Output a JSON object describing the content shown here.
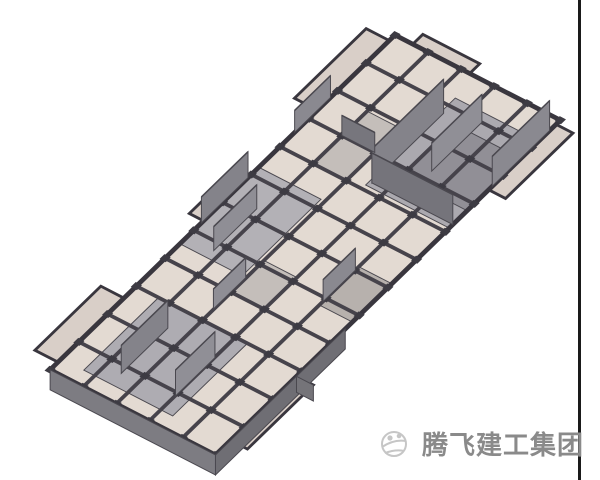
{
  "image": {
    "kind": "3d-bim-structural-floor-model",
    "background_color": "#ffffff"
  },
  "model": {
    "transform": {
      "a": 0.889,
      "b": 0.458,
      "c": -0.717,
      "d": 0.696,
      "e": 395,
      "f": 35
    },
    "slab": {
      "width_u": 186,
      "length_v": 481,
      "cols": 5,
      "rows": 12,
      "panel_color": "#e3dad2",
      "panel_color_alt": "#d9cfc8",
      "beam_color": "#46434b",
      "edge_color": "#39363e",
      "stud_color": "#3d3b43"
    },
    "wings": [
      {
        "u": -26,
        "v": 8,
        "w": 26,
        "h": 100
      },
      {
        "u": 186,
        "v": 6,
        "w": 19,
        "h": 94
      },
      {
        "u": -26,
        "v": 378,
        "w": 26,
        "h": 92
      },
      {
        "u": 186,
        "v": 368,
        "w": 19,
        "h": 92
      },
      {
        "u": -16,
        "v": 205,
        "w": 16,
        "h": 62
      },
      {
        "u": 20,
        "v": -14,
        "w": 64,
        "h": 14
      }
    ],
    "cores": [
      {
        "u": 92,
        "v": 30,
        "w": 94,
        "h": 125,
        "fill": "#aba9af"
      },
      {
        "u": 112,
        "v": 55,
        "w": 74,
        "h": 75,
        "fill": "#918f96"
      },
      {
        "u": 0,
        "v": 190,
        "w": 70,
        "h": 110,
        "fill": "#b3b1b6"
      },
      {
        "u": 25,
        "v": 360,
        "w": 100,
        "h": 105,
        "fill": "#aeacb2"
      },
      {
        "u": 37,
        "v": 85,
        "w": 37,
        "h": 75,
        "fill": "#c4beba"
      },
      {
        "u": 149,
        "v": 235,
        "w": 37,
        "h": 55,
        "fill": "#b7b1ad"
      },
      {
        "u": 74,
        "v": 275,
        "w": 38,
        "h": 45,
        "fill": "#c4beba"
      }
    ],
    "walls_up": [
      {
        "u1": 95,
        "v1": 50,
        "u2": 95,
        "v2": 150,
        "h": 34,
        "fill": "#84838a"
      },
      {
        "u1": 95,
        "v1": 150,
        "u2": 186,
        "v2": 150,
        "h": 30,
        "fill": "#75747b"
      },
      {
        "u1": 186,
        "v1": 15,
        "u2": 186,
        "v2": 95,
        "h": 30,
        "fill": "#8a8990"
      },
      {
        "u1": 130,
        "v1": 40,
        "u2": 130,
        "v2": 110,
        "h": 28,
        "fill": "#908f96"
      },
      {
        "u1": 0,
        "v1": 90,
        "u2": 0,
        "v2": 140,
        "h": 22,
        "fill": "#8a8990"
      },
      {
        "u1": 37,
        "v1": 120,
        "u2": 74,
        "v2": 120,
        "h": 20,
        "fill": "#77767d"
      },
      {
        "u1": 0,
        "v1": 205,
        "u2": 0,
        "v2": 270,
        "h": 26,
        "fill": "#84838a"
      },
      {
        "u1": 30,
        "v1": 230,
        "u2": 30,
        "v2": 290,
        "h": 24,
        "fill": "#8f8e95"
      },
      {
        "u1": 149,
        "v1": 240,
        "u2": 149,
        "v2": 285,
        "h": 22,
        "fill": "#8a8990"
      },
      {
        "u1": 74,
        "v1": 300,
        "u2": 74,
        "v2": 345,
        "h": 20,
        "fill": "#8f8e95"
      },
      {
        "u1": 55,
        "v1": 385,
        "u2": 55,
        "v2": 450,
        "h": 28,
        "fill": "#84838a"
      },
      {
        "u1": 112,
        "v1": 390,
        "u2": 112,
        "v2": 445,
        "h": 26,
        "fill": "#908f96"
      }
    ],
    "walls_down": [
      {
        "u1": 0,
        "v1": 481,
        "u2": 186,
        "v2": 481,
        "h": 20,
        "fill": "#7d7c82"
      },
      {
        "u1": 186,
        "v1": 300,
        "u2": 186,
        "v2": 481,
        "h": 20,
        "fill": "#6f6e74"
      },
      {
        "u1": 186,
        "v1": 368,
        "u2": 205,
        "v2": 368,
        "h": 16,
        "fill": "#757479"
      }
    ],
    "wall_edge_color": "#4a484f"
  },
  "right_border": {
    "x": 578,
    "width": 3,
    "color": "#1a1a1a"
  },
  "watermark": {
    "text": "腾飞建工集团",
    "text_color": "#8a8a8a",
    "logo_icon": "globe-swoosh-icon",
    "logo_color": "#c6c6c6"
  }
}
